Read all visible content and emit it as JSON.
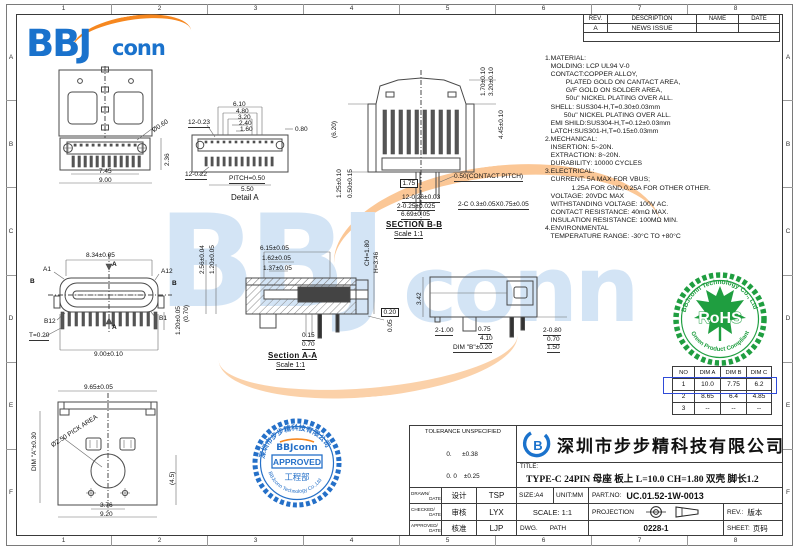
{
  "sheet": {
    "zones_top": [
      "1",
      "2",
      "3",
      "4",
      "5",
      "6",
      "7",
      "8"
    ],
    "zones_bottom": [
      "1",
      "2",
      "3",
      "4",
      "5",
      "6",
      "7",
      "8"
    ],
    "zones_left": [
      "A",
      "B",
      "C",
      "D",
      "E",
      "F"
    ],
    "zones_right": [
      "A",
      "B",
      "C",
      "D",
      "E",
      "F"
    ]
  },
  "logo": {
    "bbj": "BBJ",
    "conn": "conn"
  },
  "watermark": {
    "bbj": "BBJ",
    "conn": "conn"
  },
  "rev_table": {
    "headers": [
      "REV.",
      "DESCRIPTION",
      "NAME",
      "DATE"
    ],
    "rows": [
      {
        "rev": "A",
        "description": "NEWS ISSUE",
        "name": "",
        "date": ""
      }
    ]
  },
  "notes": [
    "1.MATERIAL:",
    "   MOLDING: LCP UL94 V-0",
    "   CONTACT:COPPER ALLOY,",
    "           PLATED GOLD ON CANTACT AREA,",
    "           G/F GOLD ON SOLDER AREA,",
    "           50u\" NICKEL PLATING OVER ALL.",
    "   SHELL: SUS304-H,T=0.30±0.03mm",
    "          50u\" NICKEL PLATING OVER ALL.",
    "   EMI SHILD:SUS304-H,T=0.12±0.03mm",
    "   LATCH:SUS301-H,T=0.15±0.03mm",
    "2.MECHANICAL:",
    "   INSERTION: 5~20N.",
    "   EXTRACTION: 8~20N.",
    "   DURABILITY: 10000 CYCLES",
    "3.ELECTRICAL:",
    "   CURRENT: 5A MAX FOR VBUS;",
    "              1.25A FOR GND,0.25A FOR OTHER OTHER.",
    "   VOLTAGE: 20VDC MAX",
    "   WITHSTANDING VOLTAGE: 100V AC.",
    "   CONTACT RESISTANCE: 40mΩ MAX.",
    "   INSULATION RESISTANCE: 100MΩ MIN.",
    "4.ENVIRONMENTAL",
    "   TEMPERATURE RANGE: -30°C TO +80°C"
  ],
  "views": {
    "back": {
      "dims": {
        "d1": "7.45",
        "d2": "9.00",
        "d3": "2.36",
        "d4": "Ø0.60"
      }
    },
    "detail_a": {
      "title": "Detail A",
      "dims": {
        "d1": "6.10",
        "d2": "4.80",
        "d3": "3.20",
        "d4": "2.40",
        "d5": "1.60",
        "d6": "0.80",
        "d7": "12-0.23",
        "d8": "12-0.22",
        "d9": "PITCH=0.50",
        "d10": "5.50"
      }
    },
    "section_bb": {
      "title": "SECTION B-B",
      "scale": "Scale 1:1",
      "dims": {
        "d1": "1.70±0.10",
        "d2": "3.20±0.10",
        "d3": "4.45±0.10",
        "d4": "(6.20)",
        "d5": "1.25±0.10",
        "d6": "0.50±0.15",
        "d7": "1.75",
        "d8": "0.50(CONTACT PITCH)",
        "d9": "12-0.26±0.03",
        "d10": "2-0.25±0.025",
        "d11": "6.69±0.05",
        "d12": "2-C 0.3±0.05X0.75±0.05"
      }
    },
    "front": {
      "dims": {
        "d1": "8.34±0.05",
        "d2": "9.00±0.10",
        "d3": "1.20±0.05",
        "d4": "(0.70)",
        "d5": "T=0.20"
      },
      "marks": {
        "a1": "A1",
        "a12": "A12",
        "b12": "B12",
        "b1": "B1",
        "b_left": "B",
        "b_right": "B",
        "a_top": "A",
        "a_bottom": "A"
      }
    },
    "section_aa": {
      "title": "Section A-A",
      "scale": "Scale 1:1",
      "dims": {
        "d1": "6.15±0.05",
        "d2": "1.62±0.05",
        "d3": "1.37±0.05",
        "d4": "2.56±0.04",
        "d5": "1.20±0.05",
        "d6": "CH=1.80",
        "d7": "H=3.46",
        "d8": "0.15",
        "d9": "0.70",
        "d10": "0.05",
        "d11": "0.20"
      }
    },
    "side": {
      "dims": {
        "d1": "3.42",
        "d2": "2-1.00",
        "d3": "0.75",
        "d4": "4.10",
        "d5": "DIM \"B\"±0.20",
        "d6": "2-0.80",
        "d7": "0.70",
        "d8": "1.50"
      }
    },
    "bottom": {
      "dims": {
        "d1": "9.65±0.05",
        "d2": "DIM \"A\"±0.30",
        "d3": "Ø2.50 PICK AREA",
        "d4": "(4.5)",
        "d5": "3.76",
        "d6": "9.20"
      }
    }
  },
  "dim_table": {
    "headers": [
      "NO",
      "DIM A",
      "DIM B",
      "DIM C"
    ],
    "rows": [
      [
        "1",
        "10.0",
        "7.75",
        "6.2"
      ],
      [
        "2",
        "8.65",
        "6.4",
        "4.85"
      ],
      [
        "3",
        "--",
        "--",
        "--"
      ]
    ],
    "highlight_row": 1,
    "highlight_color": "#2f4bd8"
  },
  "rohs_stamp": {
    "ring_top": "BBJconn Technology Co., Ltd",
    "ring_bottom": "Green Product Compliant",
    "center": "RoHS",
    "color": "#1f9e40"
  },
  "approved_stamp": {
    "logo": "BBJconn",
    "label": "APPROVED",
    "dept": "工程部",
    "ring_top": "深圳市步步精科技有限公司",
    "ring_bottom": "BBJconn Technology Co.,Ltd",
    "color": "#2570c8"
  },
  "tolerance_block": {
    "title": "TOLERANCE UNSPECIFIED",
    "rows": [
      "0.      ±0.38",
      "0. 0    ±0.25",
      "0. 00  ±0.15",
      "0. 0°     ±2°"
    ]
  },
  "title_block": {
    "company": "深圳市步步精科技有限公司",
    "title_label": "TITLE:",
    "title": "TYPE-C 24PIN 母座 板上 L=10.0 CH=1.80 双壳 脚长1.2",
    "size": "SIZE:A4",
    "unit": "UNIT:MM",
    "part_label": "PART.NO:",
    "part_no": "UC.01.52-1W-0013",
    "scale": "SCALE: 1:1",
    "projection": "PROJECTION",
    "rev_label": "REV.:",
    "rev_value": "版本",
    "dwg_label": "DWG.",
    "path_label": "PATH",
    "drawing_no": "0228-1",
    "sheet_label": "SHEET:",
    "sheet_value": "页码",
    "sign_rows": [
      {
        "en": "DRAWN/",
        "en2": "DATE",
        "cn": "设计",
        "name": "TSP"
      },
      {
        "en": "CHECKED/",
        "en2": "DATE",
        "cn": "审核",
        "name": "LYX"
      },
      {
        "en": "APPROVED/",
        "en2": "DATE",
        "cn": "核准",
        "name": "LJP"
      }
    ]
  }
}
